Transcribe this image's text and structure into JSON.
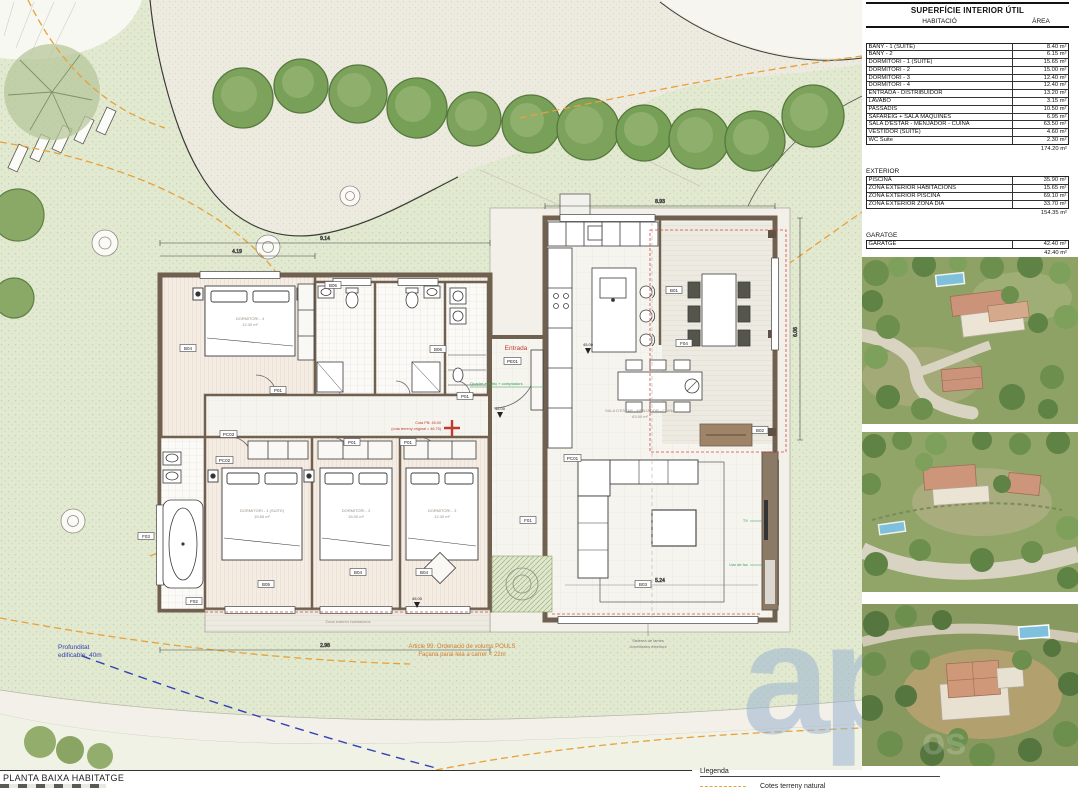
{
  "tables": {
    "interior": {
      "title": "SUPERFÍCIE INTERIOR ÚTIL",
      "col1": "HABITACIÓ",
      "col2": "ÀREA",
      "rows": [
        [
          "BANY - 1 (SUITE)",
          "8.40 m²"
        ],
        [
          "BANY - 2",
          "6.15 m²"
        ],
        [
          "DORMITORI - 1 (SUITE)",
          "15.65 m²"
        ],
        [
          "DORMITORI - 2",
          "15.00 m²"
        ],
        [
          "DORMITORI - 3",
          "12.40 m²"
        ],
        [
          "DORMITORI - 4",
          "12.40 m²"
        ],
        [
          "ENTRADA - DISTRIBUÏDOR",
          "13.20 m²"
        ],
        [
          "LAVABO",
          "3.15 m²"
        ],
        [
          "PASSADIS",
          "10.50 m²"
        ],
        [
          "SAFAREIG + SALA MÀQUINES",
          "6.95 m²"
        ],
        [
          "SALA D'ESTAR - MENJADOR - CUINA",
          "63.50 m²"
        ],
        [
          "VESTIDOR (SUITE)",
          "4.60 m²"
        ],
        [
          "WC Suite",
          "2.30 m²"
        ]
      ],
      "total": "174.20 m²"
    },
    "exterior": {
      "title": "EXTERIOR",
      "rows": [
        [
          "PISCINA",
          "35.90 m²"
        ],
        [
          "ZONA EXTERIOR HABITACIONS",
          "15.65 m²"
        ],
        [
          "ZONA EXTERIOR PISCINA",
          "69.10 m²"
        ],
        [
          "ZONA EXTERIOR ZONA DIA",
          "33.70 m²"
        ]
      ],
      "total": "154.35 m²"
    },
    "garage": {
      "title": "GARATGE",
      "rows": [
        [
          "GARATGE",
          "42.40 m²"
        ]
      ],
      "total": "42.40 m²"
    }
  },
  "plan": {
    "entrance": "Entrada",
    "tags": {
      "p01": "P01",
      "pe01": "PE01",
      "pc01": "PC01",
      "pc02": "PC02",
      "pc03": "PC03",
      "b01": "B01",
      "b02": "B02",
      "b03": "B03",
      "b04": "B04",
      "b05": "B05",
      "b06": "B06",
      "f01": "F01",
      "f02": "F02",
      "f03": "F03",
      "f04": "F04"
    },
    "levels": {
      "l1": "45.00"
    },
    "rooms": {
      "r1": "DORMITORI - 4",
      "a1": "12.40 m²",
      "r2": "DORMITORI - 1 (SUITE)",
      "a2": "15.65 m²",
      "r3": "DORMITORI - 2",
      "a3": "15.00 m²",
      "r4": "DORMITORI - 3",
      "a4": "12.40 m²",
      "r5": "SALA D'ESTAR - MENJADOR - CUINA",
      "a5": "63.50 m²"
    },
    "notes": {
      "article_line1": "Article 99. Ordenació de volums POULS",
      "article_line2": "Façana paral·lela a carrer < 22m",
      "depth_line1": "Profunditat",
      "depth_line2": "edificable, 40m",
      "shutters_line1": "Sistema de lames",
      "shutters_line2": "corredisses exteriors",
      "electric": "Quadre elèctric + comptadors",
      "tv": "TV",
      "fireplace": "Llar de foc",
      "exterior_rooms": "Zona exterior habitacions",
      "cota1": "Cota PB: 45.00",
      "cota2": "(cota terreny original = 46.75)"
    },
    "dims": {
      "d1": "9.14",
      "d2": "4.19",
      "d3": "8.93",
      "d4": "6.06",
      "d5": "5.24",
      "d6": "2.98"
    }
  },
  "footer": {
    "drawing_title": "PLANTA BAIXA HABITATGE"
  },
  "legend": {
    "title": "Llegenda",
    "item1": "Cotes terreny natural"
  },
  "watermark": {
    "text": "app"
  },
  "colors": {
    "contour_orange": "#e8a13a",
    "buildable_blue": "#3340b5",
    "entry_red": "#c0392b",
    "annotation_green": "#2e9e4f",
    "wall_brown": "#6f604f"
  }
}
